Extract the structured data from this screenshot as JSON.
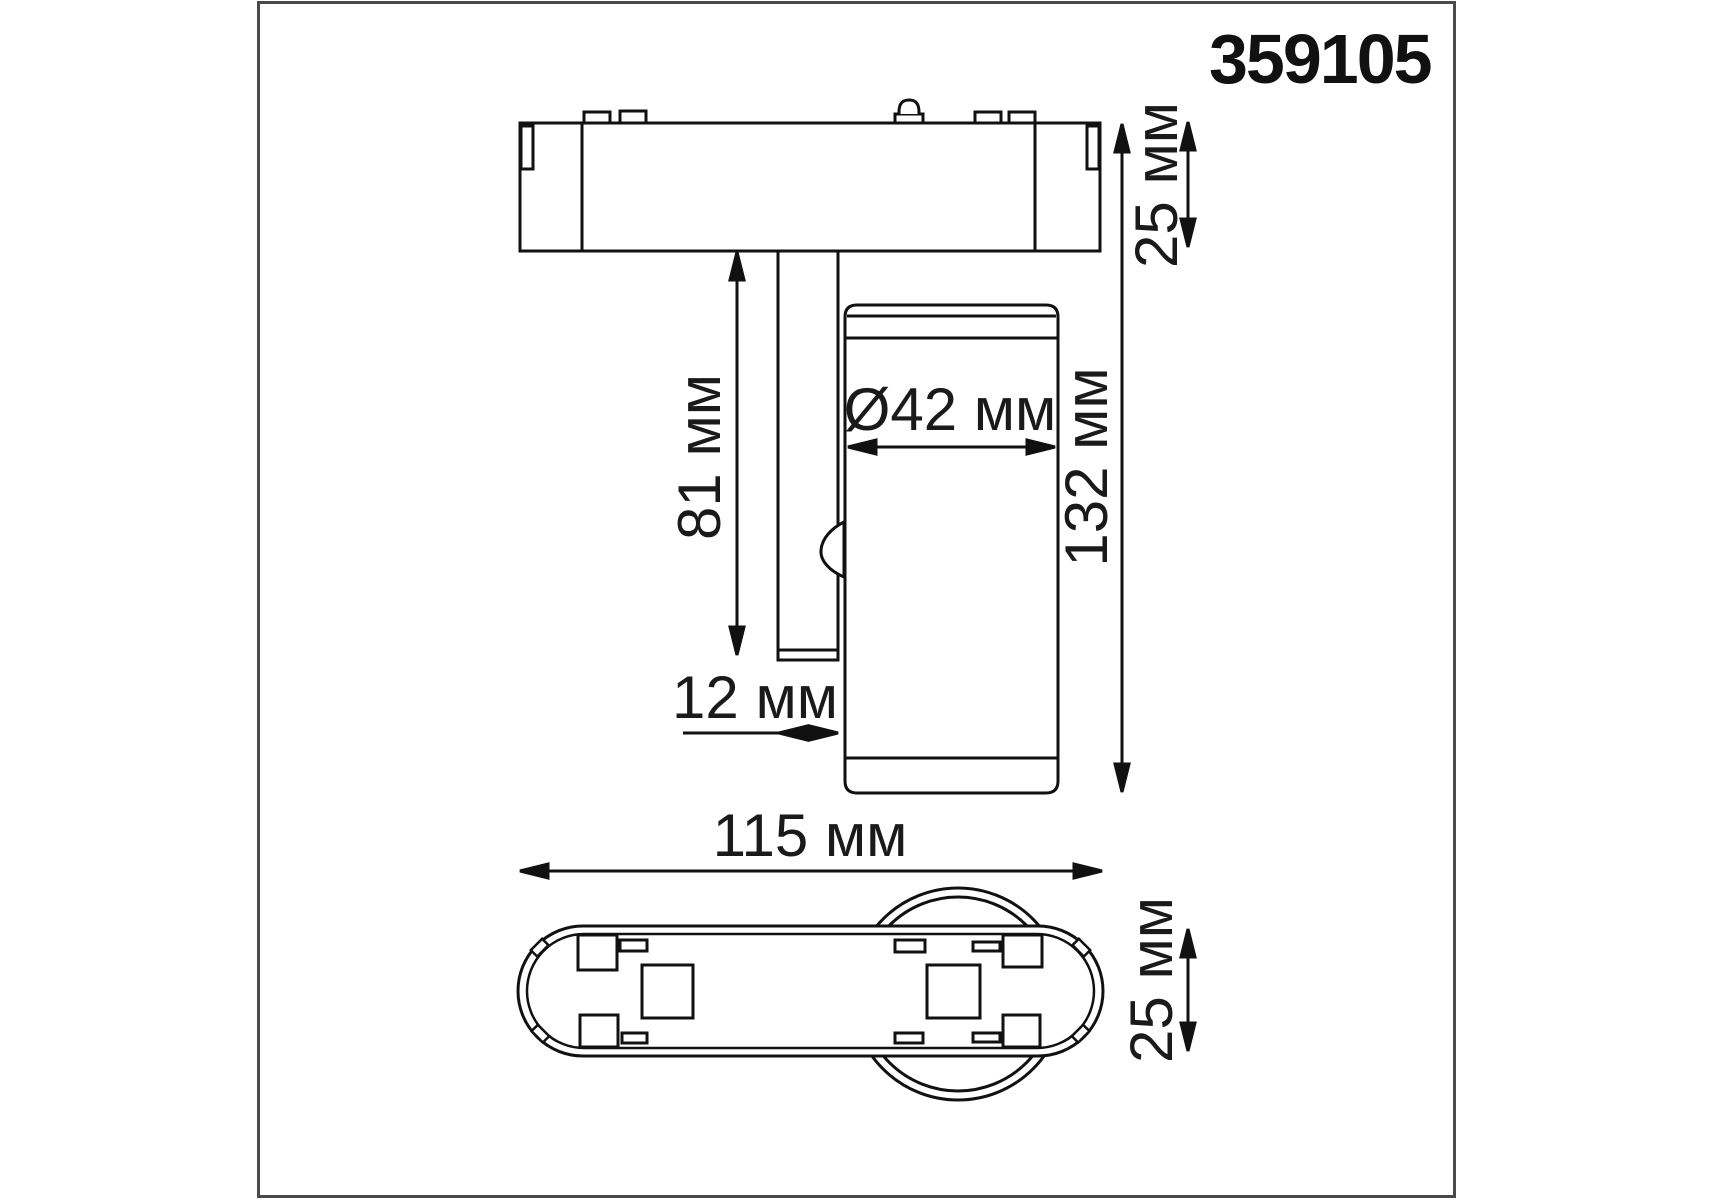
{
  "colors": {
    "ink": "#111111",
    "frame_border": "#4a4a4a",
    "background": "#ffffff"
  },
  "part_number": "359105",
  "dimension_labels": {
    "adapter_height_top": "25 мм",
    "overall_height": "132 мм",
    "stem_length": "81 мм",
    "head_diameter": "Ø42 мм",
    "stem_width": "12 мм",
    "adapter_length": "115 мм",
    "adapter_height_bottom": "25 мм"
  }
}
